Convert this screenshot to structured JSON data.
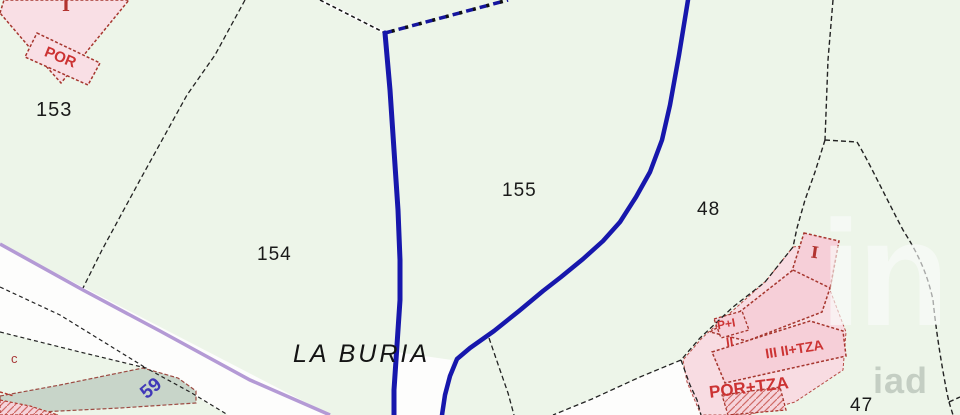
{
  "map": {
    "parcels": [
      {
        "label": "153"
      },
      {
        "label": "154"
      },
      {
        "label": "155"
      },
      {
        "label": "48"
      },
      {
        "label": "47"
      }
    ],
    "place_name": "LA BURIA",
    "road_number": "59",
    "path_letter": "c",
    "buildings": {
      "top_left_floors": "I",
      "top_left_porch": "POR",
      "right_floors": "I",
      "right_p_plus_i": "P+I",
      "right_ii": "II",
      "right_iii_tza": "III II+TZA",
      "right_por_tza": "POR+TZA"
    },
    "watermark": {
      "large": "in",
      "small": "iad"
    },
    "colors": {
      "parcel_fill": "#edf5e9",
      "hydro_line": "#1717ac",
      "road_line": "#b49ad5",
      "building_fill": "#f6cfd8",
      "building_outline": "#a6362e",
      "annotation_red": "#cc3333",
      "stream_fill": "#c8d5c9"
    }
  }
}
